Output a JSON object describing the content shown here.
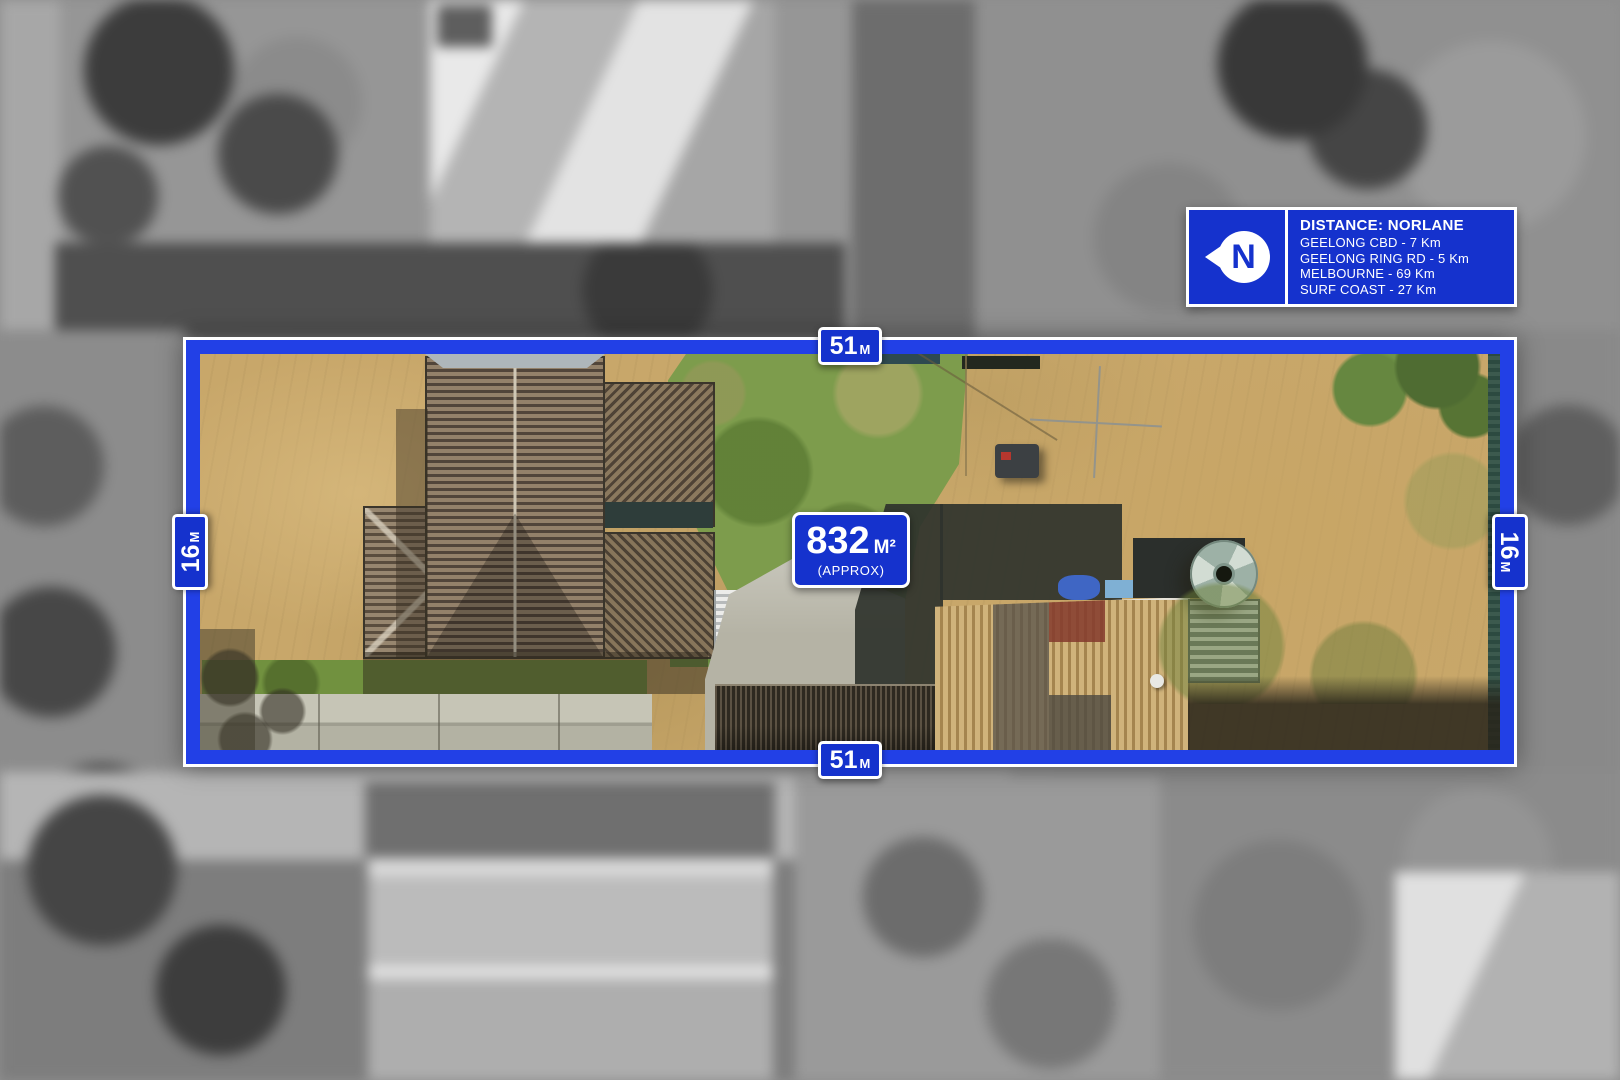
{
  "parcel": {
    "boundary": {
      "top_label": {
        "value": "51",
        "unit": "M"
      },
      "bottom_label": {
        "value": "51",
        "unit": "M"
      },
      "left_label": {
        "value": "16",
        "unit": "M"
      },
      "right_label": {
        "value": "16",
        "unit": "M"
      }
    },
    "area_label": {
      "value": "832",
      "unit": "M²",
      "qualifier": "(APPROX)"
    }
  },
  "distance_panel": {
    "north_letter": "N",
    "title": "DISTANCE: NORLANE",
    "items": [
      {
        "text": "GEELONG CBD - 7 Km"
      },
      {
        "text": "GEELONG RING RD - 5 Km"
      },
      {
        "text": "MELBOURNE - 69 Km"
      },
      {
        "text": "SURF COAST - 27 Km"
      }
    ]
  },
  "colors": {
    "sign_blue": "#1532cd",
    "boundary_blue": "#2240e6",
    "label_text": "#ffffff"
  }
}
